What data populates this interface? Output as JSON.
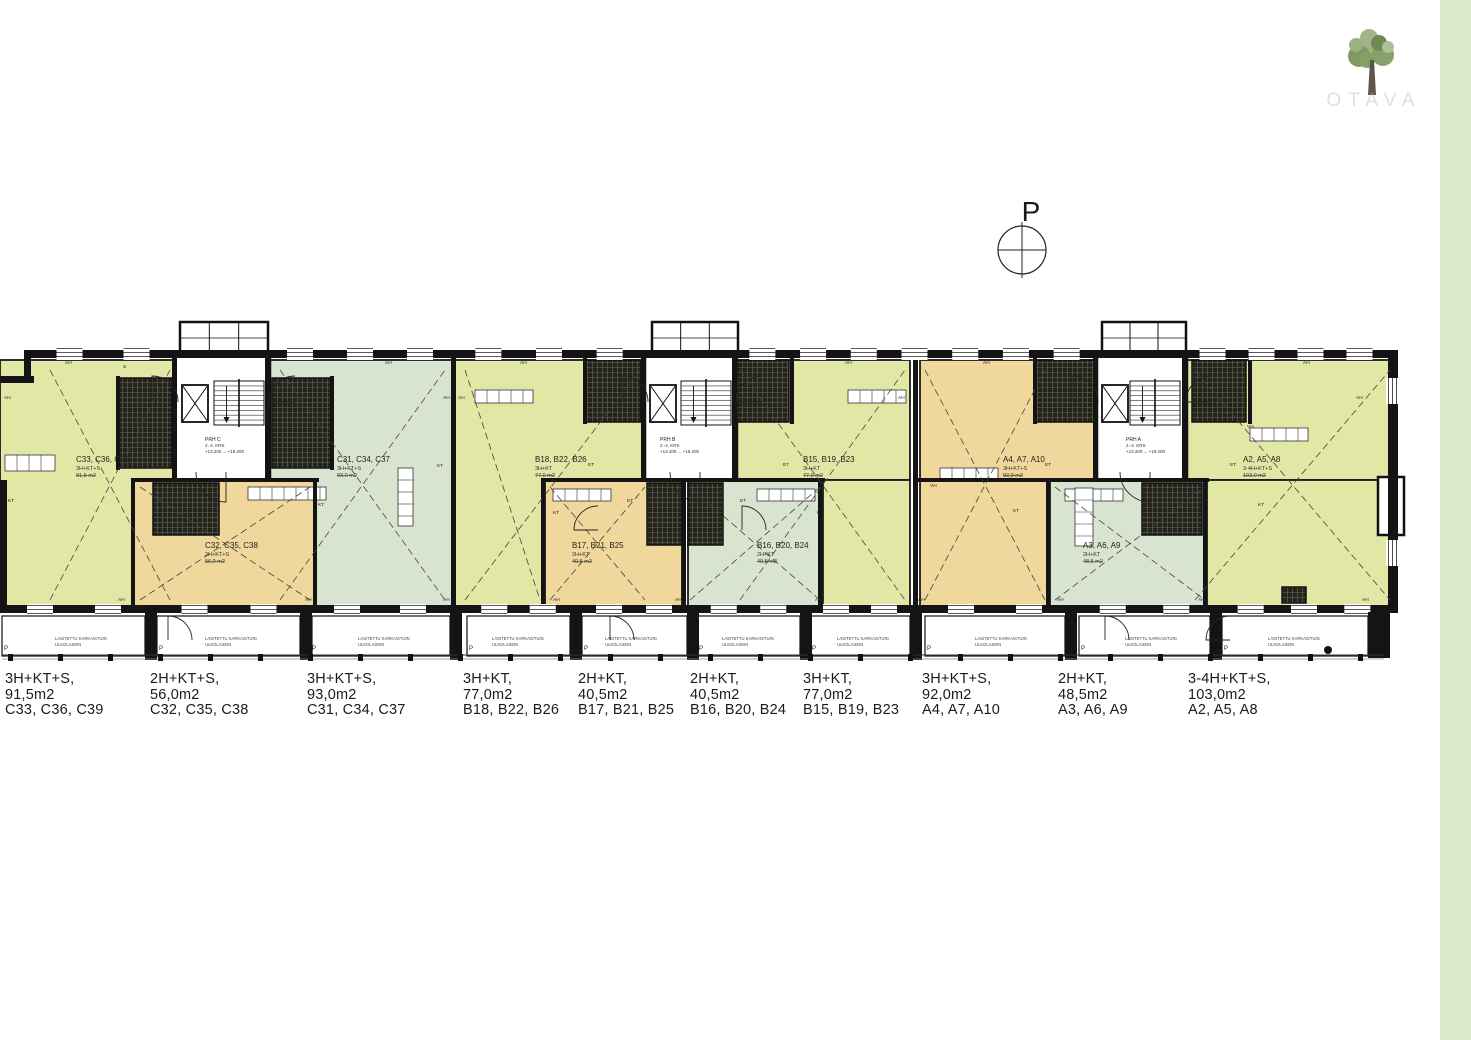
{
  "compass": {
    "label": "P"
  },
  "logo": {
    "text": "OTAVA"
  },
  "legend": {
    "x": [
      5,
      150,
      307,
      463,
      578,
      690,
      803,
      922,
      1058,
      1188
    ],
    "items": [
      {
        "type": "3H+KT+S,",
        "area": "91,5m2",
        "ids": "C33, C36, C39"
      },
      {
        "type": "2H+KT+S,",
        "area": "56,0m2",
        "ids": "C32, C35, C38"
      },
      {
        "type": "3H+KT+S,",
        "area": "93,0m2",
        "ids": "C31, C34, C37"
      },
      {
        "type": "3H+KT,",
        "area": "77,0m2",
        "ids": "B18, B22, B26"
      },
      {
        "type": "2H+KT,",
        "area": "40,5m2",
        "ids": "B17, B21, B25"
      },
      {
        "type": "2H+KT,",
        "area": "40,5m2",
        "ids": "B16, B20, B24"
      },
      {
        "type": "3H+KT,",
        "area": "77,0m2",
        "ids": "B15, B19, B23"
      },
      {
        "type": "3H+KT+S,",
        "area": "92,0m2",
        "ids": "A4, A7, A10"
      },
      {
        "type": "2H+KT,",
        "area": "48,5m2",
        "ids": "A3, A6, A9"
      },
      {
        "type": "3-4H+KT+S,",
        "area": "103,0m2",
        "ids": "A2, A5, A8"
      }
    ]
  },
  "plan": {
    "palette": {
      "green": "#e3e7a6",
      "orange": "#f0d79b",
      "teal": "#d8e4cf",
      "hatch": "#23231c",
      "wall": "#141414",
      "paper_strip": "#dce8ca"
    },
    "rooms": [
      [
        0,
        360,
        175,
        252,
        "green"
      ],
      [
        270,
        360,
        185,
        252,
        "teal"
      ],
      [
        133,
        480,
        182,
        132,
        "orange"
      ],
      [
        455,
        360,
        190,
        252,
        "green"
      ],
      [
        545,
        480,
        137,
        132,
        "orange"
      ],
      [
        688,
        480,
        135,
        132,
        "teal"
      ],
      [
        735,
        360,
        175,
        120,
        "green"
      ],
      [
        823,
        480,
        87,
        132,
        "green"
      ],
      [
        920,
        360,
        177,
        120,
        "orange"
      ],
      [
        920,
        480,
        130,
        132,
        "orange"
      ],
      [
        1050,
        480,
        157,
        132,
        "teal"
      ],
      [
        1187,
        360,
        208,
        120,
        "green"
      ],
      [
        1207,
        480,
        188,
        132,
        "green"
      ]
    ],
    "whites": [
      [
        175,
        352,
        95,
        128
      ],
      [
        645,
        352,
        92,
        128
      ],
      [
        1097,
        352,
        90,
        128
      ],
      [
        180,
        322,
        88,
        32
      ],
      [
        652,
        322,
        86,
        32
      ],
      [
        1102,
        322,
        84,
        32
      ],
      [
        1378,
        477,
        26,
        58
      ]
    ],
    "darks": [
      [
        118,
        378,
        54,
        90
      ],
      [
        272,
        378,
        60,
        90
      ],
      [
        153,
        483,
        66,
        52
      ],
      [
        585,
        360,
        56,
        62
      ],
      [
        737,
        360,
        52,
        62
      ],
      [
        647,
        483,
        35,
        62
      ],
      [
        688,
        483,
        35,
        62
      ],
      [
        1035,
        360,
        60,
        62
      ],
      [
        1192,
        360,
        54,
        62
      ],
      [
        1142,
        483,
        60,
        52
      ],
      [
        1282,
        587,
        24,
        16
      ]
    ],
    "walls": [
      [
        28,
        350,
        1362,
        8
      ],
      [
        0,
        376,
        34,
        7
      ],
      [
        24,
        350,
        7,
        33
      ],
      [
        0,
        605,
        1395,
        8
      ],
      [
        1388,
        350,
        10,
        263
      ],
      [
        0,
        480,
        7,
        132
      ],
      [
        172,
        352,
        5,
        130
      ],
      [
        265,
        352,
        5,
        130
      ],
      [
        641,
        352,
        5,
        130
      ],
      [
        732,
        352,
        5,
        130
      ],
      [
        1093,
        352,
        5,
        130
      ],
      [
        1182,
        352,
        5,
        130
      ],
      [
        451,
        356,
        5,
        256
      ],
      [
        913,
        356,
        5,
        256
      ],
      [
        131,
        478,
        188,
        4
      ],
      [
        541,
        478,
        284,
        4
      ],
      [
        918,
        478,
        291,
        4
      ],
      [
        131,
        482,
        4,
        130
      ],
      [
        313,
        482,
        4,
        130
      ],
      [
        541,
        482,
        4,
        130
      ],
      [
        682,
        482,
        4,
        130
      ],
      [
        818,
        482,
        4,
        130
      ],
      [
        1046,
        482,
        4,
        130
      ],
      [
        1203,
        482,
        4,
        130
      ],
      [
        116,
        376,
        4,
        94
      ],
      [
        330,
        376,
        4,
        94
      ],
      [
        583,
        358,
        4,
        66
      ],
      [
        790,
        358,
        4,
        66
      ],
      [
        1033,
        358,
        4,
        66
      ],
      [
        1248,
        358,
        4,
        66
      ]
    ],
    "fixtures": [
      [
        5,
        455,
        50,
        16
      ],
      [
        248,
        487,
        78,
        13
      ],
      [
        398,
        468,
        15,
        58
      ],
      [
        475,
        390,
        58,
        13
      ],
      [
        848,
        390,
        58,
        13
      ],
      [
        553,
        489,
        58,
        12
      ],
      [
        757,
        489,
        58,
        12
      ],
      [
        940,
        468,
        58,
        13
      ],
      [
        1065,
        489,
        58,
        12
      ],
      [
        1250,
        428,
        58,
        13
      ],
      [
        1075,
        488,
        18,
        58
      ]
    ],
    "stairwells": [
      {
        "elev": [
          182,
          385,
          26,
          37
        ],
        "stairs": [
          214,
          381,
          50,
          44
        ],
        "label": [
          205,
          441
        ],
        "name": "PRH C"
      },
      {
        "elev": [
          650,
          385,
          26,
          37
        ],
        "stairs": [
          681,
          381,
          50,
          44
        ],
        "label": [
          660,
          441
        ],
        "name": "PRH B"
      },
      {
        "elev": [
          1102,
          385,
          26,
          37
        ],
        "stairs": [
          1130,
          381,
          50,
          44
        ],
        "label": [
          1126,
          441
        ],
        "name": "PRH A"
      }
    ],
    "core_krs": "2.-4. KRS",
    "core_level": "+13.200 ... +19.200",
    "windows": {
      "top_y": 347,
      "bottom_y": 604,
      "h": 13,
      "w": 26,
      "step": 47,
      "top_ranges": [
        [
          36,
          170
        ],
        [
          270,
          450
        ],
        [
          458,
          640
        ],
        [
          737,
          1092
        ],
        [
          1188,
          1384
        ]
      ],
      "bottom_ranges": [
        [
          6,
          142
        ],
        [
          160,
          298
        ],
        [
          314,
          446
        ],
        [
          470,
          567
        ],
        [
          584,
          684
        ],
        [
          699,
          798
        ],
        [
          812,
          908
        ],
        [
          927,
          1063
        ],
        [
          1081,
          1208
        ],
        [
          1224,
          1384
        ]
      ],
      "right_side": [
        [
          1386,
          378
        ],
        [
          1386,
          540
        ]
      ]
    },
    "balconies": {
      "y": 616,
      "h": 40,
      "boxes": [
        [
          2,
          145
        ],
        [
          157,
          300
        ],
        [
          312,
          450
        ],
        [
          467,
          570
        ],
        [
          582,
          687
        ],
        [
          697,
          800
        ],
        [
          810,
          910
        ],
        [
          925,
          1065
        ],
        [
          1079,
          1210
        ],
        [
          1222,
          1368
        ]
      ],
      "dividers": [
        145,
        300,
        450,
        570,
        687,
        800,
        910,
        1065,
        1210
      ],
      "end_wall": [
        1368,
        612,
        22,
        46
      ],
      "texts_x": [
        55,
        205,
        358,
        492,
        605,
        722,
        837,
        975,
        1125,
        1268
      ],
      "p_x": [
        4,
        159,
        312,
        469,
        584,
        699,
        812,
        927,
        1081,
        1224
      ],
      "note1": "LASITETTU KARKAISTUIN",
      "note2": "ULKOLASEIN",
      "p": "P",
      "posts_from": 8,
      "posts_to": 1380,
      "posts_step": 50
    },
    "dashes": [
      [
        50,
        370,
        170,
        600
      ],
      [
        50,
        600,
        170,
        370
      ],
      [
        280,
        370,
        445,
        600
      ],
      [
        280,
        600,
        445,
        370
      ],
      [
        140,
        487,
        310,
        600
      ],
      [
        140,
        600,
        310,
        487
      ],
      [
        465,
        370,
        540,
        600
      ],
      [
        465,
        600,
        640,
        370
      ],
      [
        550,
        487,
        645,
        600
      ],
      [
        550,
        600,
        645,
        487
      ],
      [
        690,
        487,
        820,
        600
      ],
      [
        690,
        600,
        820,
        487
      ],
      [
        740,
        370,
        905,
        600
      ],
      [
        740,
        600,
        905,
        370
      ],
      [
        925,
        370,
        1045,
        600
      ],
      [
        925,
        600,
        1045,
        370
      ],
      [
        1055,
        487,
        1205,
        600
      ],
      [
        1055,
        600,
        1205,
        487
      ],
      [
        1195,
        370,
        1390,
        600
      ],
      [
        1195,
        600,
        1390,
        370
      ]
    ],
    "arcs": [
      [
        226,
        472,
        30,
        90,
        180
      ],
      [
        152,
        402,
        26,
        270,
        360
      ],
      [
        295,
        402,
        26,
        180,
        270
      ],
      [
        700,
        472,
        30,
        90,
        180
      ],
      [
        622,
        402,
        26,
        270,
        360
      ],
      [
        762,
        402,
        26,
        180,
        270
      ],
      [
        1150,
        472,
        30,
        90,
        180
      ],
      [
        1072,
        402,
        26,
        270,
        360
      ],
      [
        1212,
        402,
        26,
        180,
        270
      ],
      [
        598,
        530,
        24,
        180,
        270
      ],
      [
        742,
        530,
        24,
        270,
        360
      ],
      [
        168,
        640,
        24,
        270,
        360
      ],
      [
        610,
        640,
        24,
        270,
        360
      ],
      [
        1105,
        640,
        24,
        270,
        360
      ],
      [
        1230,
        640,
        24,
        180,
        270
      ]
    ],
    "apartments": [
      {
        "x": 76,
        "y": 462,
        "ids": "C33, C36, C39",
        "type": "3H+KT+S",
        "area": "91,5 m2"
      },
      {
        "x": 337,
        "y": 462,
        "ids": "C31, C34, C37",
        "type": "3H+KT+S",
        "area": "93,0 m2"
      },
      {
        "x": 205,
        "y": 548,
        "ids": "C32, C35, C38",
        "type": "2H+KT+S",
        "area": "56,0 m2"
      },
      {
        "x": 535,
        "y": 462,
        "ids": "B18, B22, B26",
        "type": "3H+KT",
        "area": "77,0 m2"
      },
      {
        "x": 803,
        "y": 462,
        "ids": "B15, B19, B23",
        "type": "3H+KT",
        "area": "77,0 m2"
      },
      {
        "x": 572,
        "y": 548,
        "ids": "B17, B21, B25",
        "type": "2H+KT",
        "area": "40,5 m2"
      },
      {
        "x": 757,
        "y": 548,
        "ids": "B16, B20, B24",
        "type": "2H+KT",
        "area": "40,5 m2"
      },
      {
        "x": 1003,
        "y": 462,
        "ids": "A4, A7, A10",
        "type": "3H+KT+S",
        "area": "92,0 m2"
      },
      {
        "x": 1243,
        "y": 462,
        "ids": "A2, A5, A8",
        "type": "3-4H+KT+S",
        "area": "103,0 m2"
      },
      {
        "x": 1083,
        "y": 548,
        "ids": "A3, A6, A9",
        "type": "2H+KT",
        "area": "48,5 m2"
      }
    ],
    "micro": {
      "AH": [
        [
          65,
          364
        ],
        [
          385,
          364
        ],
        [
          4,
          399
        ],
        [
          443,
          399
        ],
        [
          520,
          364
        ],
        [
          845,
          364
        ],
        [
          458,
          399
        ],
        [
          898,
          399
        ],
        [
          983,
          364
        ],
        [
          1303,
          364
        ],
        [
          1356,
          399
        ],
        [
          118,
          601
        ],
        [
          305,
          601
        ],
        [
          443,
          601
        ],
        [
          553,
          601
        ],
        [
          675,
          601
        ],
        [
          815,
          601
        ],
        [
          918,
          601
        ],
        [
          1057,
          601
        ],
        [
          1198,
          601
        ],
        [
          1362,
          601
        ]
      ],
      "KT": [
        [
          8,
          502
        ],
        [
          318,
          506
        ],
        [
          437,
          467
        ],
        [
          553,
          514
        ],
        [
          817,
          514
        ],
        [
          1013,
          512
        ],
        [
          1258,
          506
        ]
      ],
      "ET": [
        [
          125,
          466
        ],
        [
          320,
          467
        ],
        [
          588,
          466
        ],
        [
          783,
          466
        ],
        [
          627,
          502
        ],
        [
          740,
          502
        ],
        [
          1045,
          466
        ],
        [
          1230,
          466
        ]
      ],
      "VH": [
        [
          930,
          487
        ],
        [
          1247,
          428
        ]
      ],
      "S": [
        [
          123,
          368
        ],
        [
          593,
          368
        ],
        [
          1043,
          368
        ]
      ]
    },
    "dot": [
      1328,
      650,
      4
    ]
  }
}
